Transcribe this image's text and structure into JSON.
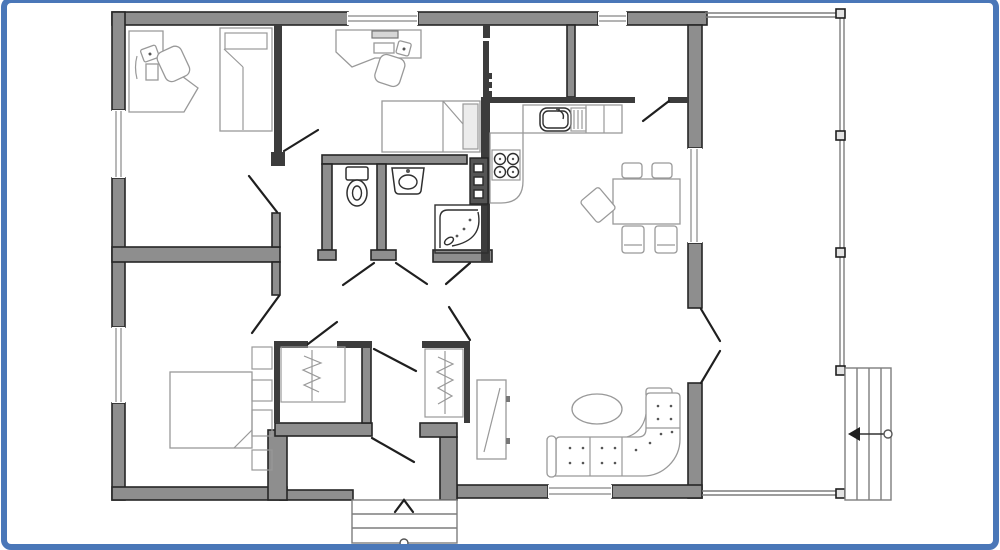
{
  "frame": {
    "border_color": "#4a77b8",
    "background": "#ffffff"
  },
  "palette": {
    "wall_fill": "#8e8e8e",
    "wall_stroke": "#262626",
    "thin_wall": "#3c3c3c",
    "furniture_stroke": "#999999",
    "dark_fixture_stroke": "#2f2f2f",
    "window_line": "#9a9a9a",
    "porch_line": "#7d7d7d",
    "door_line": "#1f1f1f",
    "light_fill": "#ececec"
  },
  "plan": {
    "type": "floor-plan",
    "text_labels": [],
    "rooms": [
      {
        "name": "office",
        "furniture": [
          "corner-desk",
          "desk-chair",
          "monitor",
          "keyboard",
          "single-bed"
        ]
      },
      {
        "name": "small-bedroom",
        "furniture": [
          "corner-desk",
          "desk-chair",
          "laptop",
          "single-bed"
        ]
      },
      {
        "name": "kitchen",
        "furniture": [
          "counter",
          "sink",
          "drainer",
          "stove-4-burner",
          "tall-utility-unit"
        ]
      },
      {
        "name": "dining-area",
        "furniture": [
          "dining-table",
          "chair",
          "chair",
          "chair",
          "chair",
          "chair"
        ]
      },
      {
        "name": "bathroom",
        "furniture": [
          "toilet",
          "washbasin",
          "shower-cabin"
        ]
      },
      {
        "name": "hallway",
        "furniture": [
          "wardrobe-with-hangers",
          "wardrobe-with-hangers",
          "mirror-cabinet"
        ]
      },
      {
        "name": "master-bedroom",
        "furniture": [
          "double-bed",
          "bedside-cabinets"
        ]
      },
      {
        "name": "living-room",
        "furniture": [
          "corner-sofa",
          "oval-coffee-table"
        ]
      },
      {
        "name": "porch",
        "furniture": [
          "railing-posts",
          "side-steps",
          "entrance-steps"
        ]
      }
    ],
    "annotations": [
      "entrance-arrow-up",
      "porch-entry-arrow-left",
      "door-swings",
      "windows"
    ]
  }
}
